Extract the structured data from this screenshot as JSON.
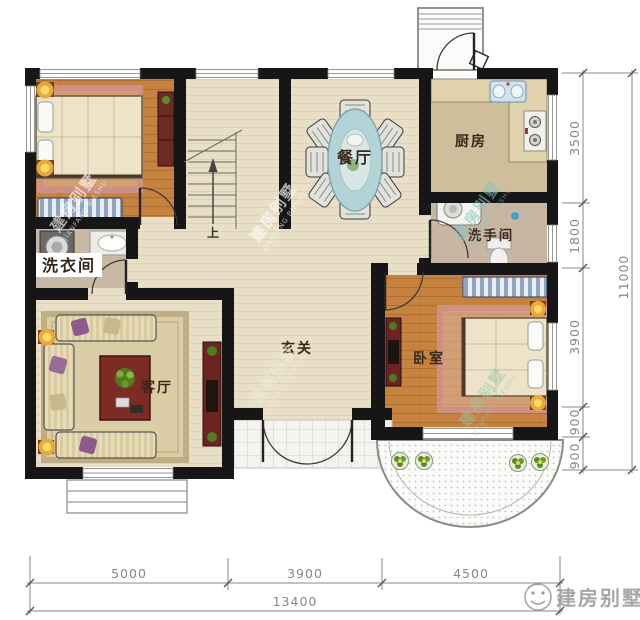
{
  "rooms": {
    "dining": "餐厅",
    "kitchen": "厨房",
    "washroom": "洗手间",
    "laundry": "洗衣间",
    "living": "客厅",
    "foyer": "玄关",
    "bedroom": "卧室",
    "stairs_up": "上"
  },
  "dimensions": {
    "bottom": {
      "segments": [
        "5000",
        "3900",
        "4500"
      ],
      "total": "13400"
    },
    "right": {
      "segments": [
        "3500",
        "1800",
        "3900",
        "900",
        "900"
      ],
      "total": "11000"
    }
  },
  "watermark": {
    "cn": "建房别墅",
    "en": "JIANFANG BIESHU"
  },
  "logo": {
    "brand": "建房别墅"
  },
  "colors": {
    "wall": "#161616",
    "floor_main": "#e9dfc6",
    "floor_wood": "#c6823f",
    "floor_service": "#c9b8a3",
    "rug_pink": "#e7c9bd",
    "table_blue": "#b2d4d6",
    "counter": "#e0d3ab",
    "cabinet_red": "#6b2420",
    "dimension_text": "#8a8784"
  }
}
